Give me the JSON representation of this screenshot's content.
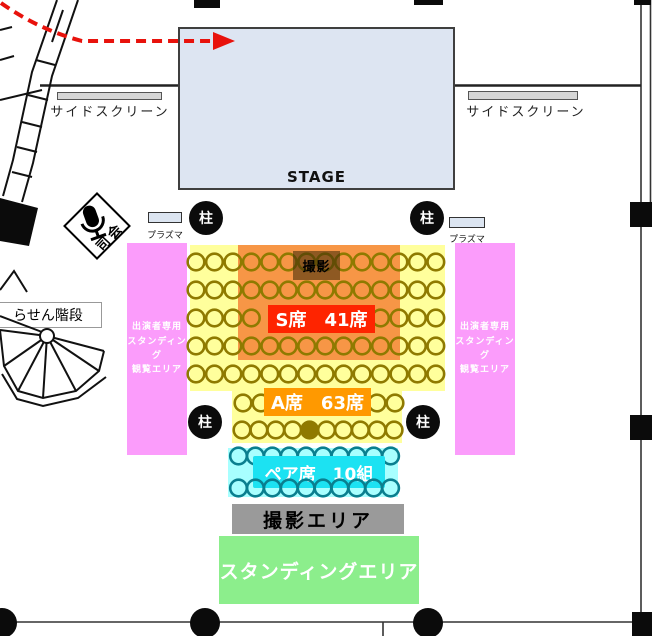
{
  "map": {
    "stage_label": "STAGE",
    "left_screen_label": "サイドスクリーン",
    "right_screen_label": "サイドスクリーン",
    "mc_label": "司会",
    "plasma_label_left": "プラズマ",
    "plasma_label_right": "プラズマ",
    "pillar_label": "柱",
    "spiral_staircase_label": "らせん階段",
    "side_area_lines": [
      "出演者専用",
      "スタンディング",
      "観覧エリア"
    ],
    "photo_spot_label": "撮影",
    "s_seats_label": "S席　41席",
    "a_seats_label": "A席　63席",
    "pair_seats_label": "ペア席　10組",
    "camera_area_label": "撮影エリア",
    "standing_area_label": "スタンディングエリア"
  },
  "colors": {
    "stage": "#dde5f2",
    "side_area": "#fb9cfb",
    "seat_area": "#ffff9c",
    "s_area": "#f79646",
    "s_label": "#fe2400",
    "a_label": "#ff9900",
    "pair_area": "#a8ffff",
    "pair_label": "#1ce2f2",
    "camera_area": "#9a9a9a",
    "standing_area": "#8cee8c",
    "arrow": "#e8120c",
    "seat_stroke": "#8f7a00",
    "pair_seat_stroke": "#0a7f8f"
  }
}
